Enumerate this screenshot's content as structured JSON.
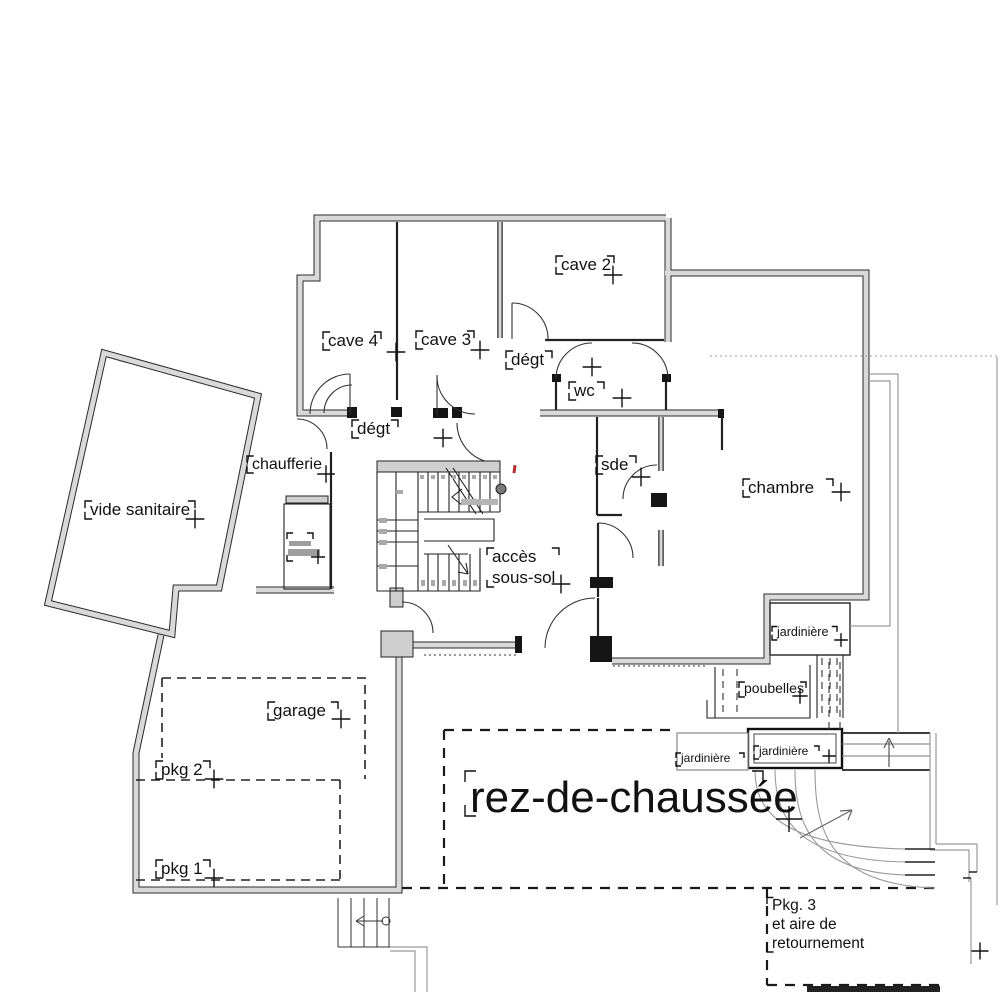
{
  "title": "rez-de-chaussée — plan d'architecte",
  "floor_label": "rez-de-chaussée",
  "colors": {
    "background": "#ffffff",
    "wall_fill": "#d9d9d9",
    "wall_edge": "#2a2a2a",
    "partition": "#222222",
    "thin_outline": "#999999",
    "dashed": "#1a1a1a",
    "red_mark": "#b03030",
    "stair_rail": "#b5b5b5",
    "newel": "#7a7a7a",
    "ink": "#111111"
  },
  "rooms": [
    "cave 2",
    "cave 3",
    "cave 4",
    "dégt",
    "wc",
    "sde",
    "chambre",
    "vide sanitaire",
    "chaufferie",
    "accès sous-sol",
    "garage",
    "pkg 2",
    "pkg 1",
    "jardinière",
    "poubelles",
    "rez-de-chaussée",
    "Pkg. 3 et aire de retournement"
  ],
  "labels": [
    {
      "id": "cave2",
      "lines": [
        "cave 2"
      ],
      "x": 561,
      "y": 270,
      "fs": 17,
      "w": 48,
      "ticks": [
        "tl",
        "bl",
        "tr"
      ],
      "plus": [
        613,
        275
      ]
    },
    {
      "id": "cave4",
      "lines": [
        "cave 4"
      ],
      "x": 328,
      "y": 346,
      "fs": 17,
      "w": 48,
      "ticks": [
        "tl",
        "bl",
        "tr"
      ],
      "plus": [
        396,
        352
      ]
    },
    {
      "id": "cave3",
      "lines": [
        "cave 3"
      ],
      "x": 421,
      "y": 345,
      "fs": 17,
      "w": 48,
      "ticks": [
        "tl",
        "bl",
        "tr"
      ],
      "plus": [
        480,
        350
      ]
    },
    {
      "id": "degt-upper",
      "lines": [
        "dégt"
      ],
      "x": 511,
      "y": 365,
      "fs": 17,
      "w": 36,
      "ticks": [
        "tl",
        "bl",
        "tr"
      ],
      "plus": [
        592,
        367
      ]
    },
    {
      "id": "wc",
      "lines": [
        "wc"
      ],
      "x": 574,
      "y": 396,
      "fs": 17,
      "w": 25,
      "ticks": [
        "tl",
        "bl",
        "tr"
      ],
      "plus": [
        622,
        398
      ]
    },
    {
      "id": "degt-lower",
      "lines": [
        "dégt"
      ],
      "x": 357,
      "y": 434,
      "fs": 17,
      "w": 36,
      "ticks": [
        "tl",
        "bl",
        "tr"
      ],
      "plus": [
        443,
        438
      ]
    },
    {
      "id": "sde",
      "lines": [
        "sde"
      ],
      "x": 601,
      "y": 470,
      "fs": 17,
      "w": 30,
      "ticks": [
        "tl",
        "bl",
        "tr"
      ],
      "plus": [
        641,
        477
      ]
    },
    {
      "id": "chambre",
      "lines": [
        "chambre"
      ],
      "x": 748,
      "y": 493,
      "fs": 17,
      "w": 80,
      "ticks": [
        "tl",
        "bl",
        "tr"
      ],
      "plus": [
        841,
        492
      ]
    },
    {
      "id": "vide-sanitaire",
      "lines": [
        "vide sanitaire"
      ],
      "x": 90,
      "y": 515,
      "fs": 17,
      "w": 100,
      "ticks": [
        "tl",
        "bl",
        "tr"
      ],
      "plus": [
        195,
        519
      ]
    },
    {
      "id": "chaufferie",
      "lines": [
        "chaufferie"
      ],
      "x": 252,
      "y": 469,
      "fs": 16,
      "w": 73,
      "ticks": [
        "tl",
        "bl"
      ],
      "plus": [
        326,
        474
      ]
    },
    {
      "id": "acces-sous-sol",
      "lines": [
        "accès",
        "sous-sol"
      ],
      "x": 492,
      "y": 562,
      "fs": 17,
      "w": 62,
      "lh": 21,
      "ticks": [
        "tl",
        "bl",
        "tr"
      ],
      "plus": [
        561,
        584
      ]
    },
    {
      "id": "garage",
      "lines": [
        "garage"
      ],
      "x": 273,
      "y": 716,
      "fs": 17,
      "w": 60,
      "ticks": [
        "tl",
        "bl",
        "tr"
      ],
      "plus": [
        341,
        719
      ]
    },
    {
      "id": "pkg2",
      "lines": [
        "pkg 2"
      ],
      "x": 161,
      "y": 775,
      "fs": 17,
      "w": 44,
      "ticks": [
        "tl",
        "bl",
        "tr"
      ],
      "plus": [
        214,
        779
      ]
    },
    {
      "id": "pkg1",
      "lines": [
        "pkg 1"
      ],
      "x": 161,
      "y": 874,
      "fs": 17,
      "w": 44,
      "ticks": [
        "tl",
        "bl",
        "tr"
      ],
      "plus": [
        214,
        878
      ]
    },
    {
      "id": "rez-de-chaussee",
      "lines": [
        "rez-de-chaussée"
      ],
      "x": 470,
      "y": 812,
      "fs": 44,
      "w": 288,
      "ticks": [
        "tl",
        "bl",
        "tr"
      ],
      "plus": [
        789,
        819
      ]
    },
    {
      "id": "jardiniere-1",
      "lines": [
        "jardinière"
      ],
      "x": 777,
      "y": 636,
      "fs": 12.5,
      "w": 55,
      "ticks": [
        "tl",
        "bl",
        "tr"
      ],
      "plus": [
        841,
        640
      ]
    },
    {
      "id": "poubelles",
      "lines": [
        "poubelles"
      ],
      "x": 744,
      "y": 693,
      "fs": 14,
      "w": 57,
      "ticks": [
        "tl",
        "bl",
        "tr"
      ],
      "plus": [
        800,
        696
      ]
    },
    {
      "id": "jardiniere-2",
      "lines": [
        "jardinière"
      ],
      "x": 759,
      "y": 755,
      "fs": 12,
      "w": 55,
      "ticks": [
        "tl",
        "bl",
        "tr"
      ],
      "plus": [
        829,
        756
      ]
    },
    {
      "id": "jardiniere-3",
      "lines": [
        "jardinière"
      ],
      "x": 681,
      "y": 762,
      "fs": 12,
      "w": 58,
      "ticks": [
        "tl",
        "bl",
        "tr"
      ],
      "plus": null
    },
    {
      "id": "pkg3",
      "lines": [
        "Pkg. 3",
        "et aire de",
        "retournement"
      ],
      "x": 772,
      "y": 910,
      "fs": 15.5,
      "w": 100,
      "lh": 19,
      "ticks": [
        "tl",
        "bl"
      ],
      "plus": [
        980,
        951
      ]
    }
  ]
}
